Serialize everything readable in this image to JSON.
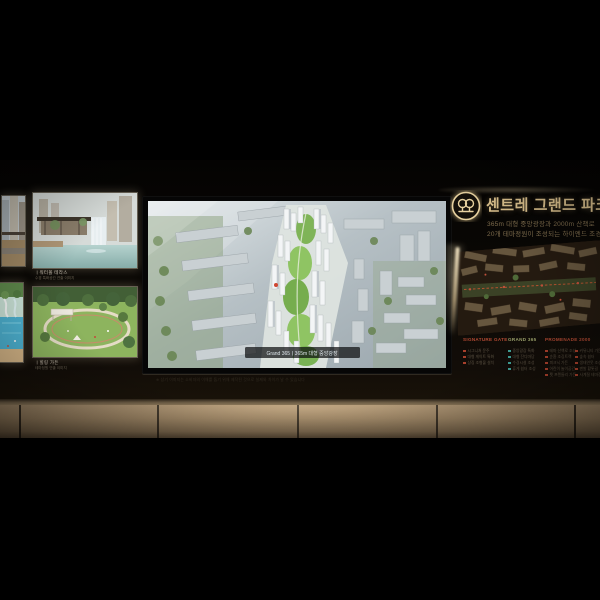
{
  "header": {
    "title": "센트레 그랜드 파크",
    "subtitle_line1": "365m 대형 중앙광장과 2000m 산책로",
    "subtitle_line2": "20개 테마정원이 조성되는 하이엔드 조경",
    "logo_icon": "twin-trees-emblem",
    "accent_color": "#dcc28e"
  },
  "tv": {
    "label": "Grand 365ㅣ365m 대형 중앙광장",
    "disclaimer": "※ 상기 이미지는 소비자의 이해를 돕기 위해 제작된 것으로 실제와 차이가 날 수 있습니다"
  },
  "left_panels": [
    {
      "caption": "ㅣ워터폴 테라스",
      "subcaption": "수경 특화공간 연출 이미지"
    },
    {
      "caption": "ㅣ힐링 가든",
      "subcaption": "테마정원 연출 이미지"
    }
  ],
  "site_plan": {
    "columns": [
      {
        "header": "SIGNATURE GATE",
        "header_color": "#b44a33",
        "bullet_color": "#a8402c",
        "items": [
          "시그니처 문주",
          "대형 게이트 특화",
          "상징 조형물 설치"
        ]
      },
      {
        "header": "GRAND 365",
        "header_color": "#9aa06a",
        "bullet_color": "#3f9f96",
        "items": [
          "중앙광장 특화",
          "대형 잔디마당",
          "수경시설 조성",
          "휴게 쉼터 조성"
        ]
      },
      {
        "header": "PROMENADE 2000",
        "header_color": "#b44a33",
        "bullet_color": "#a8402c",
        "items_left": [
          "테마 산책로 조성",
          "순환 조깅트랙",
          "피크닉 가든",
          "어린이 놀이공간",
          "펫 프렌들리 가든"
        ],
        "items_right": [
          "커뮤니티 가든",
          "숲속 쉼터",
          "생태연못 조성",
          "맨발 황톳길",
          "사계절 테마정원"
        ]
      }
    ],
    "led_color": "#ffe9c2"
  }
}
